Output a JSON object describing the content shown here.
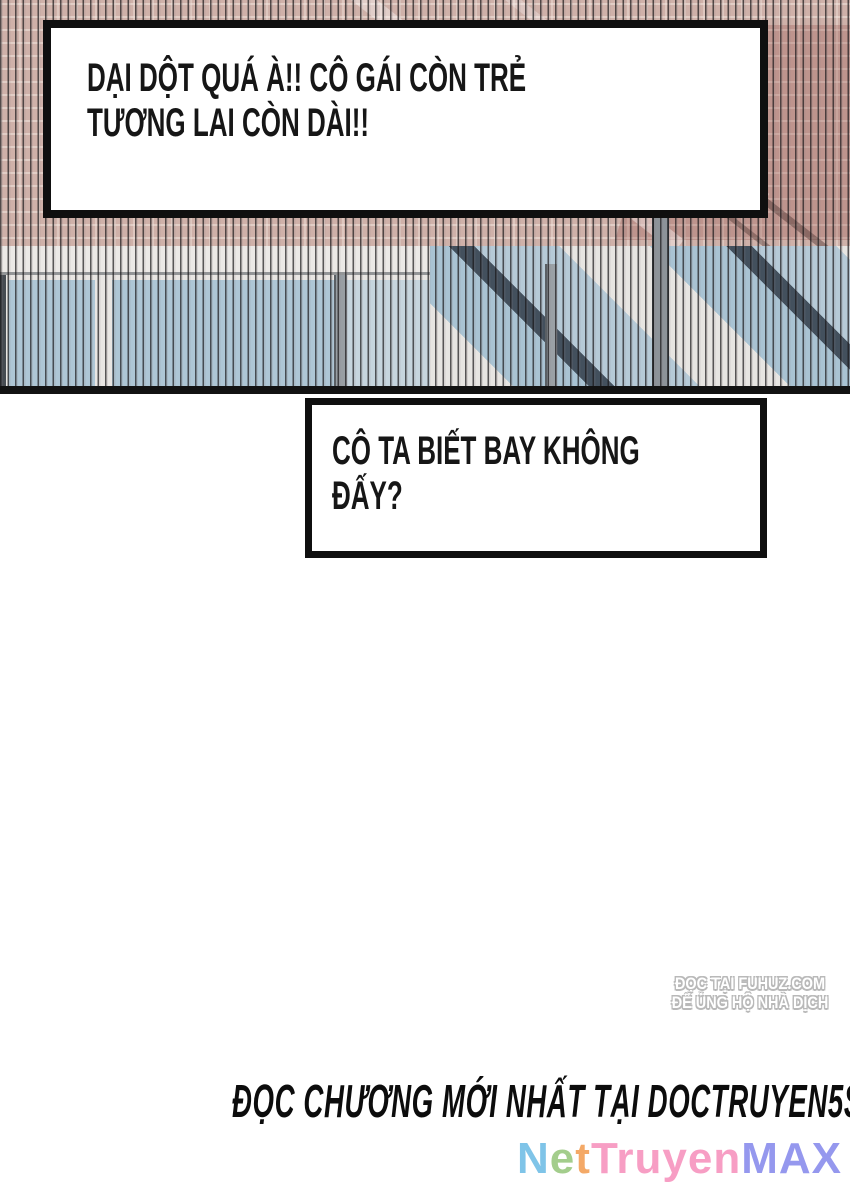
{
  "page": {
    "background": "#ffffff"
  },
  "photo": {
    "description": "striped building facade with brick wall and blue window band, diagonal shadows",
    "colors": {
      "brick": "#cfb1a9",
      "mortar": "#f2e5de",
      "wall": "#ece9e6",
      "window_blue": "#aec6d5",
      "window_pale": "#c6d5de",
      "shadow": "#43505d",
      "frame": "#474c52",
      "pillar": "#8d9399",
      "bottom_edge": "#121212"
    }
  },
  "bubbles": [
    {
      "lines": [
        "DẠI DỘT QUÁ À!! CÔ GÁI CÒN TRẺ",
        "TƯƠNG LAI CÒN DÀI!!"
      ]
    },
    {
      "lines": [
        "CÔ TA BIẾT BAY KHÔNG",
        "ĐẤY?"
      ]
    }
  ],
  "watermark": {
    "lines": [
      "ĐỌC TẠI FUHUZ.COM",
      "ĐỂ ỦNG HỘ NHÀ DỊCH"
    ],
    "outline_color": "#b9b9b9"
  },
  "footer": {
    "promo_text": "ĐỌC CHƯƠNG MỚI NHẤT TẠI DOCTRUYEN5S.NET",
    "logo": {
      "text": "NetTruyenMAX",
      "segments": [
        {
          "text": "N",
          "color": "#7fc4e8"
        },
        {
          "text": "e",
          "color": "#a3cd8c"
        },
        {
          "text": "t",
          "color": "#f4a967"
        },
        {
          "text": "Truyen",
          "color": "#f79ec4"
        },
        {
          "text": "MAX",
          "color": "#9598ee"
        }
      ]
    }
  }
}
